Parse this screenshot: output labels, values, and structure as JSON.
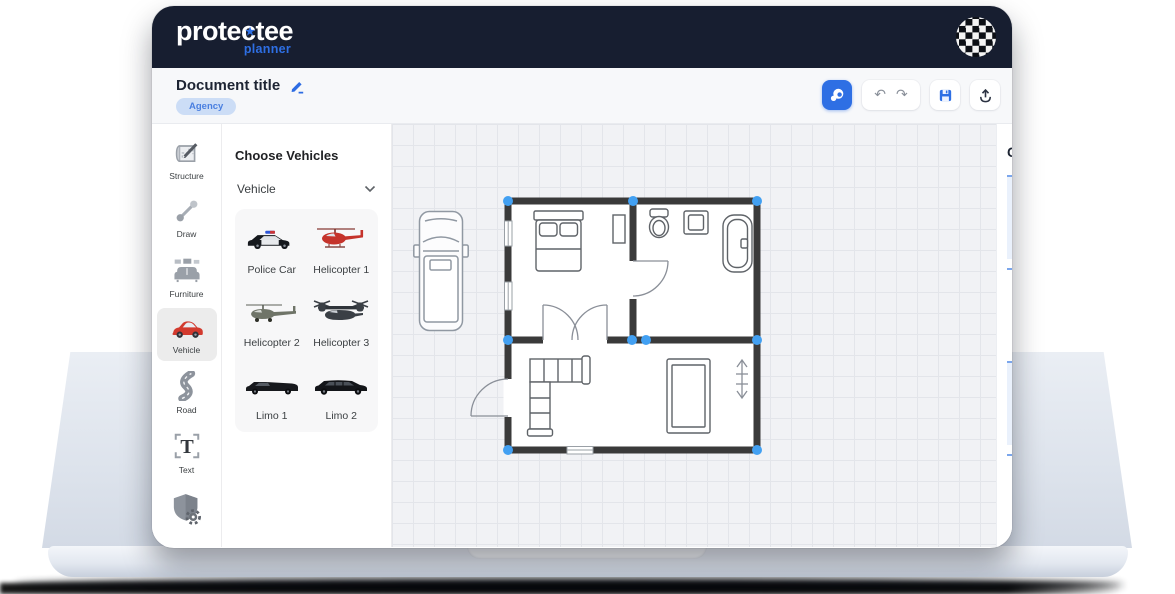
{
  "app": {
    "logo_part1": "prote",
    "logo_c": "c",
    "logo_star": "★",
    "logo_part2": "tee",
    "logo_subtitle": "planner",
    "avatar": "checkered-circle"
  },
  "toolbar": {
    "document_title": "Document title",
    "badge_label": "Agency",
    "undo_glyph": "↶",
    "redo_glyph": "↷",
    "buttons": [
      {
        "name": "assistant",
        "icon": "chat-icon"
      },
      {
        "name": "undo",
        "icon": "undo-icon"
      },
      {
        "name": "redo",
        "icon": "redo-icon"
      },
      {
        "name": "save",
        "icon": "save-icon"
      },
      {
        "name": "export",
        "icon": "upload-icon"
      }
    ]
  },
  "sidebar": {
    "items": [
      {
        "label": "Structure",
        "icon": "blueprint-pencil-icon",
        "active": false
      },
      {
        "label": "Draw",
        "icon": "line-endpoints-icon",
        "active": false
      },
      {
        "label": "Furniture",
        "icon": "sofa-icon",
        "active": false
      },
      {
        "label": "Vehicle",
        "icon": "red-car-icon",
        "active": true
      },
      {
        "label": "Road",
        "icon": "winding-road-icon",
        "active": false
      },
      {
        "label": "Text",
        "icon": "text-t-icon",
        "active": false
      },
      {
        "label": "",
        "icon": "shield-gear-icon",
        "active": false
      }
    ]
  },
  "vehicle_panel": {
    "title": "Choose Vehicles",
    "dropdown_value": "Vehicle",
    "items": [
      {
        "name": "Police Car",
        "icon": "police-car-thumb"
      },
      {
        "name": "Helicopter 1",
        "icon": "red-helicopter-thumb"
      },
      {
        "name": "Helicopter 2",
        "icon": "military-helicopter-thumb"
      },
      {
        "name": "Helicopter 3",
        "icon": "tiltrotor-thumb"
      },
      {
        "name": "Limo 1",
        "icon": "limo-thumb"
      },
      {
        "name": "Limo 2",
        "icon": "limo-thumb"
      }
    ]
  },
  "canvas": {
    "objects": [
      "van-top-view",
      "floor-plan-bedroom-bathroom-livingroom"
    ],
    "floor_plan_furniture": [
      "double-bed",
      "closet",
      "toilet",
      "sink",
      "bathtub",
      "interior-door",
      "double-doors",
      "sectional-sofa",
      "rug",
      "wall-marker",
      "entrance-door",
      "windows"
    ],
    "selection_handle_color": "#42a0f2",
    "wall_color": "#3a3a3a"
  },
  "right_panel": {
    "heading": "C",
    "items": [
      {
        "number": "#1",
        "icon": "checkered-flag-icon",
        "label": "Sc"
      },
      {
        "number": "#2",
        "icon": "checkered-flag-icon",
        "label": "Sc"
      },
      {
        "number": "#3",
        "icon": "checkered-flag-icon",
        "label": "Sc"
      },
      {
        "number": "#4",
        "icon": "checkered-flag-icon",
        "label": "Sc"
      }
    ]
  },
  "colors": {
    "header_bg": "#171e30",
    "accent_blue": "#2e6fe4",
    "badge_bg": "#ccddf6",
    "badge_text": "#4a7fe0",
    "canvas_bg": "#f1f2f5",
    "grid_line": "#e3e5ea",
    "vehicle_red": "#d23a2e",
    "card_tint": "#eaf1fc",
    "card_top_border": "#7ba6ec"
  }
}
